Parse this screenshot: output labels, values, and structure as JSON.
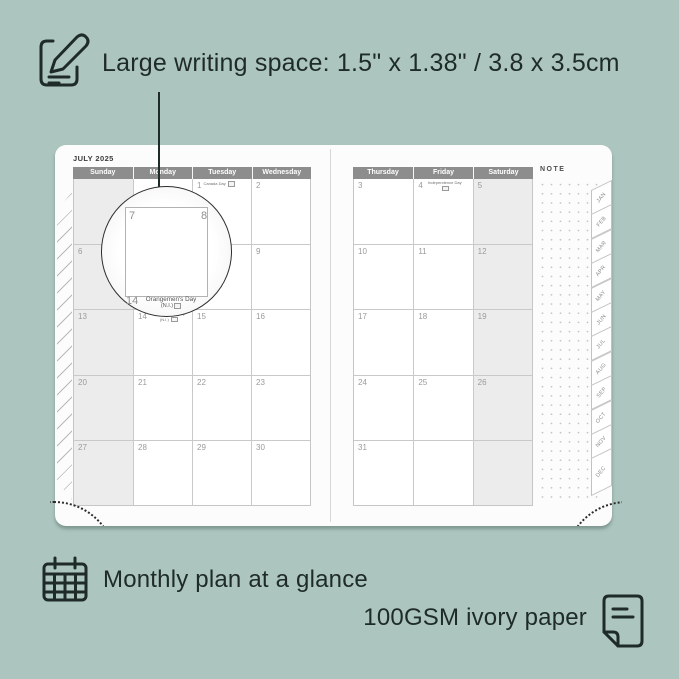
{
  "colors": {
    "background": "#adc5bf",
    "ink": "#1e2b28",
    "page": "#fcfcfc",
    "header_bar": "#8d8d8d",
    "shaded_column": "#ececec"
  },
  "annotations": {
    "top": {
      "icon": "note-pencil-icon",
      "text": "Large writing space: 1.5\" x 1.38\" / 3.8 x 3.5cm"
    },
    "bottom_left": {
      "icon": "calendar-grid-icon",
      "text": "Monthly plan at a glance"
    },
    "bottom_right": {
      "icon": "paper-sheet-icon",
      "text": "100GSM ivory paper"
    }
  },
  "planner": {
    "month_title": "JULY 2025",
    "note_label": "NOTE",
    "left_page": {
      "headers": [
        "Sunday",
        "Monday",
        "Tuesday",
        "Wednesday"
      ],
      "shaded_col": 0,
      "rows": [
        [
          {
            "date": ""
          },
          {
            "date": ""
          },
          {
            "date": "1",
            "holiday": "Canada Day"
          },
          {
            "date": "2"
          }
        ],
        [
          {
            "date": "6"
          },
          {
            "date": "7"
          },
          {
            "date": "8"
          },
          {
            "date": "9"
          }
        ],
        [
          {
            "date": "13"
          },
          {
            "date": "14",
            "holiday": "Orangemen's Day (N.I.)"
          },
          {
            "date": "15"
          },
          {
            "date": "16"
          }
        ],
        [
          {
            "date": "20"
          },
          {
            "date": "21"
          },
          {
            "date": "22"
          },
          {
            "date": "23"
          }
        ],
        [
          {
            "date": "27"
          },
          {
            "date": "28"
          },
          {
            "date": "29"
          },
          {
            "date": "30"
          }
        ]
      ]
    },
    "right_page": {
      "headers": [
        "Thursday",
        "Friday",
        "Saturday"
      ],
      "shaded_col": 2,
      "rows": [
        [
          {
            "date": "3"
          },
          {
            "date": "4",
            "holiday": "Independence Day"
          },
          {
            "date": "5"
          }
        ],
        [
          {
            "date": "10"
          },
          {
            "date": "11"
          },
          {
            "date": "12"
          }
        ],
        [
          {
            "date": "17"
          },
          {
            "date": "18"
          },
          {
            "date": "19"
          }
        ],
        [
          {
            "date": "24"
          },
          {
            "date": "25"
          },
          {
            "date": "26"
          }
        ],
        [
          {
            "date": "31"
          },
          {
            "date": ""
          },
          {
            "date": ""
          }
        ]
      ]
    },
    "month_tabs": [
      "JAN",
      "FEB",
      "MAR",
      "APR",
      "MAY",
      "JUN",
      "JUL",
      "AUG",
      "SEP",
      "OCT",
      "NOV",
      "DEC"
    ]
  },
  "magnifier": {
    "day_large": "7",
    "day_right": "8",
    "day_below": "14",
    "holiday_line1": "Orangemen's Day",
    "holiday_line2": "(N.I.)"
  }
}
